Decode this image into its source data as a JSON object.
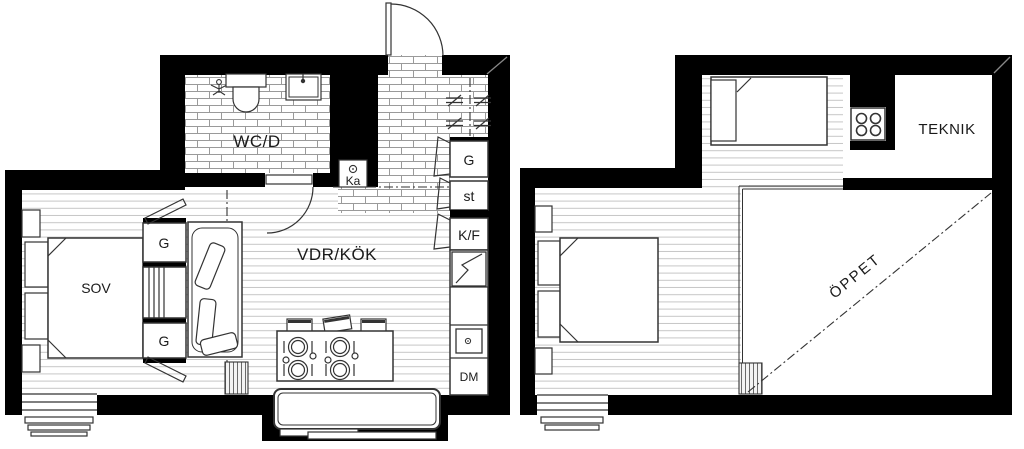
{
  "lower_plan": {
    "bathroom_label": "WC/D",
    "living_kitchen_label": "VDR/KÖK",
    "bedroom_label": "SOV",
    "wardrobe_label": "G",
    "wardrobe_label_2": "G",
    "tall_cabinet_label": "G",
    "cleaning_closet_label": "st",
    "fridge_freezer_label": "K/F",
    "dishwasher_label": "DM",
    "fireplace_label": "Ka"
  },
  "upper_plan": {
    "utility_label": "TEKNIK",
    "open_to_below_label": "ÖPPET"
  },
  "colors": {
    "wall": "#000000",
    "outline": "#333333",
    "plank_line": "#c6c6c6",
    "tile_line": "#9a9a9a",
    "background": "#ffffff"
  }
}
